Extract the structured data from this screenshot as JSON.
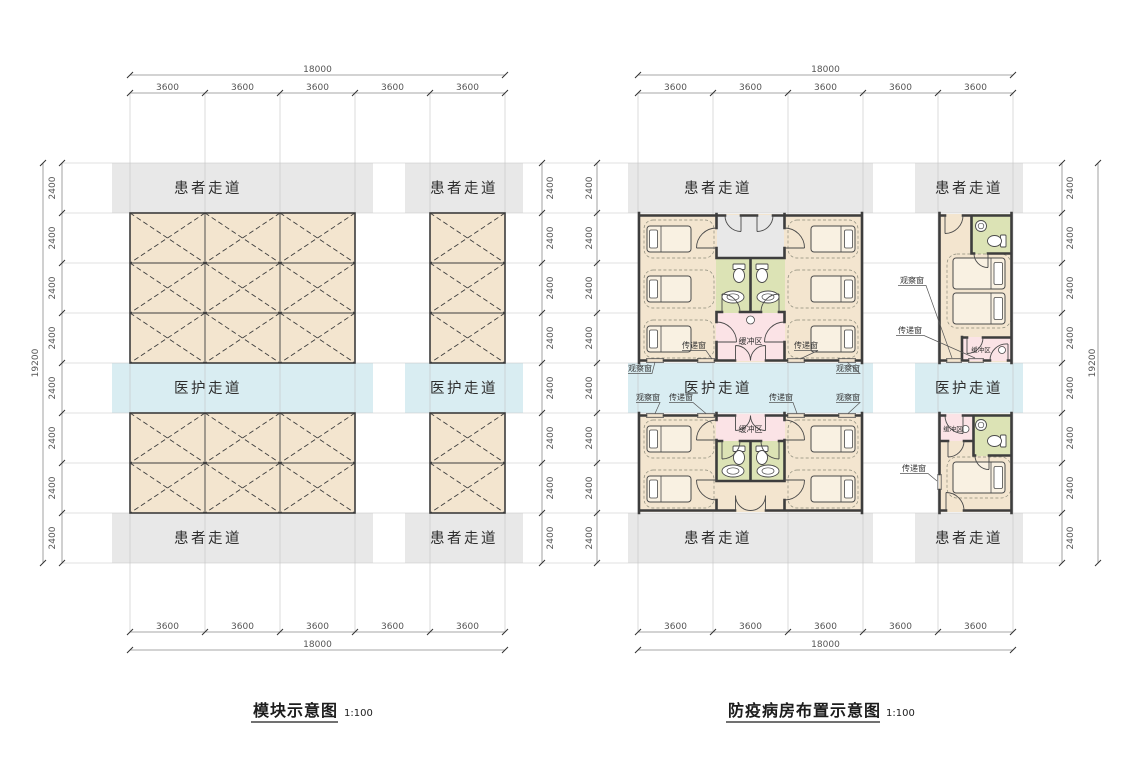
{
  "titles": {
    "left": "模块示意图",
    "right": "防疫病房布置示意图",
    "scale": "1:100"
  },
  "labels": {
    "patient_corridor": "患者走道",
    "staff_corridor": "医护走道",
    "buffer_zone": "缓冲区",
    "transfer_window": "传递窗",
    "observation_window": "观察窗"
  },
  "dims": {
    "left_plan": {
      "width_total": "18000",
      "top": [
        "3600",
        "3600",
        "3600",
        "3600",
        "3600"
      ],
      "bottom": [
        "3600",
        "3600",
        "3600",
        "3600",
        "3600"
      ],
      "height_total": "19200",
      "left": [
        "2400",
        "2400",
        "2400",
        "2400",
        "2400",
        "2400",
        "2400",
        "2400"
      ],
      "right": [
        "2400",
        "2400",
        "2400",
        "2400",
        "2400",
        "2400",
        "2400",
        "2400"
      ]
    },
    "right_plan": {
      "width_total": "18000",
      "top": [
        "3600",
        "3600",
        "3600",
        "3600",
        "3600"
      ],
      "bottom": [
        "3600",
        "3600",
        "3600",
        "3600",
        "3600"
      ],
      "height_total": "19200",
      "left": [
        "2400",
        "2400",
        "2400",
        "2400",
        "2400",
        "2400",
        "2400",
        "2400"
      ],
      "right": [
        "2400",
        "2400",
        "2400",
        "2400",
        "2400",
        "2400",
        "2400",
        "2400"
      ]
    }
  },
  "colors": {
    "module_fill": "#f3e5cf",
    "patient_corridor": "#e8e8e8",
    "staff_corridor": "#d9edf2",
    "bathroom": "#dce3b5",
    "buffer": "#fbe3e6",
    "wall": "#3d3d3d"
  }
}
